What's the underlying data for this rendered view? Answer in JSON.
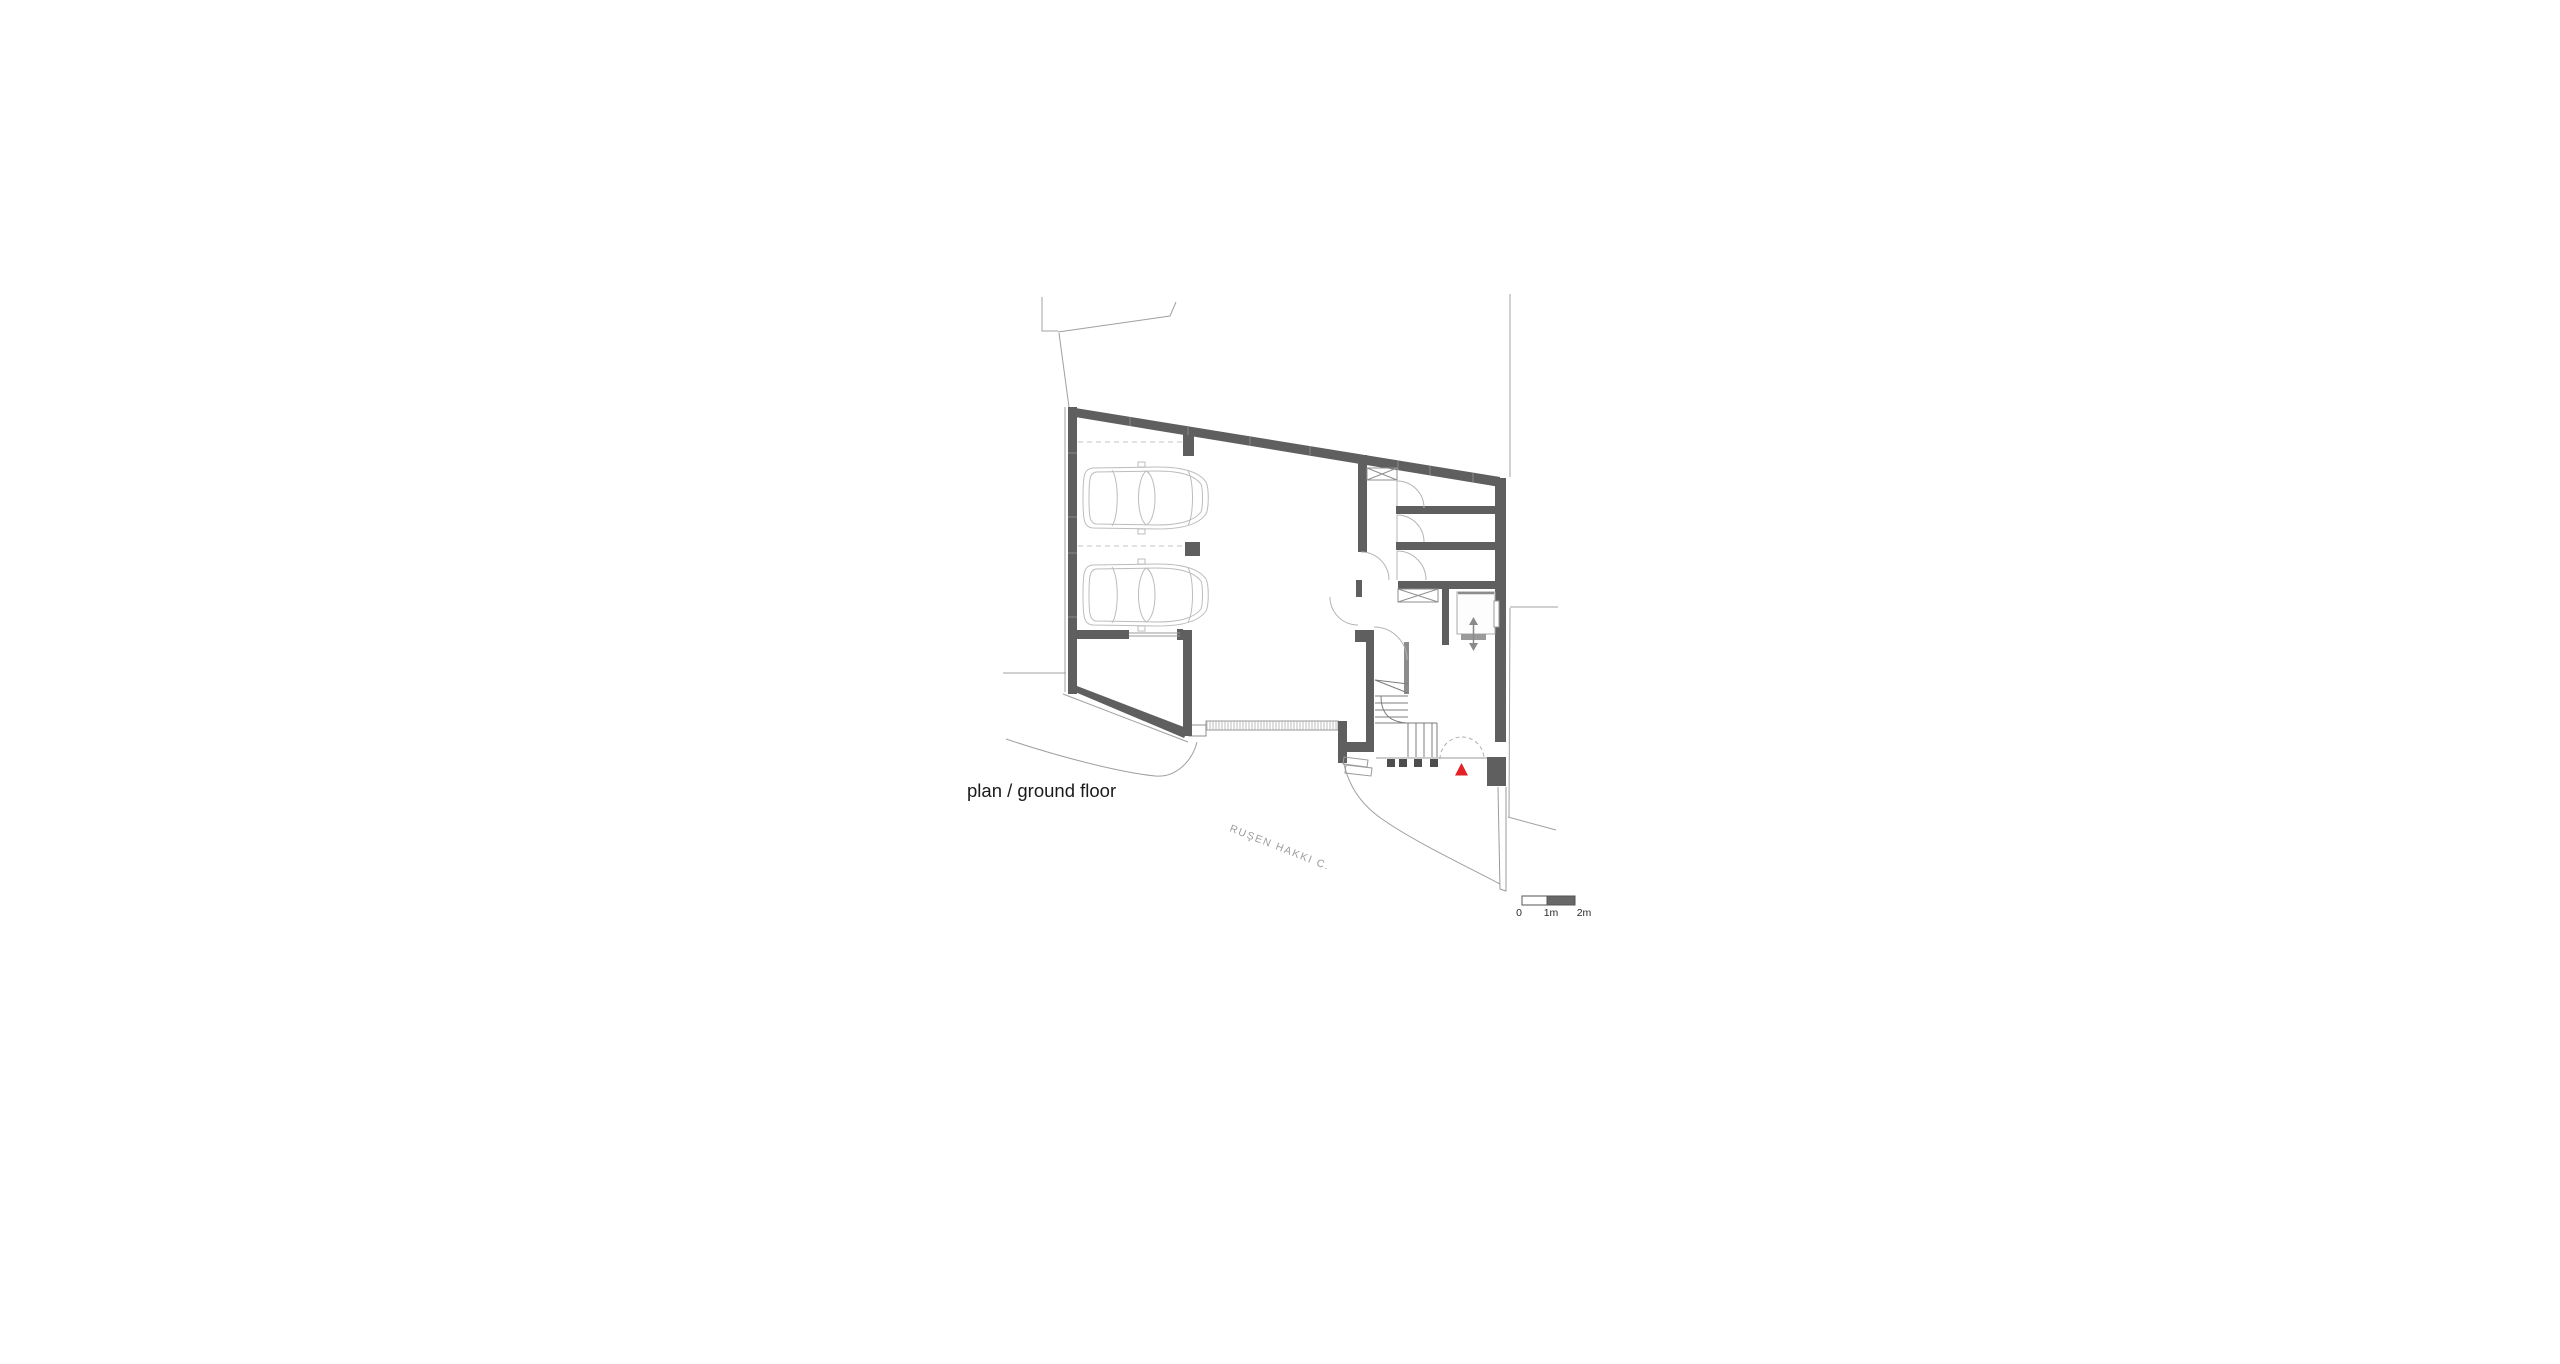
{
  "drawing": {
    "title": "plan / ground floor",
    "street_label": "RUŞEN HAKKI C.",
    "scale_bar": {
      "label_0": "0",
      "label_1m": "1m",
      "label_2m": "2m"
    },
    "colors": {
      "background": "#ffffff",
      "wall_gray": "#5f5f5f",
      "thin_line_gray": "#a0a0a0",
      "car_outline_gray": "#bcbcbc",
      "street_text_gray": "#9c9c9c",
      "title_text": "#1b1b1b",
      "entrance_marker_red": "#e32126",
      "scale_bar_dark": "#686868"
    },
    "icons": {
      "entrance_marker": "red-triangle-up",
      "elevator_symbol": "up-down-arrow",
      "window_marker": "x-cross-box",
      "car": "sedan-top-view"
    }
  }
}
